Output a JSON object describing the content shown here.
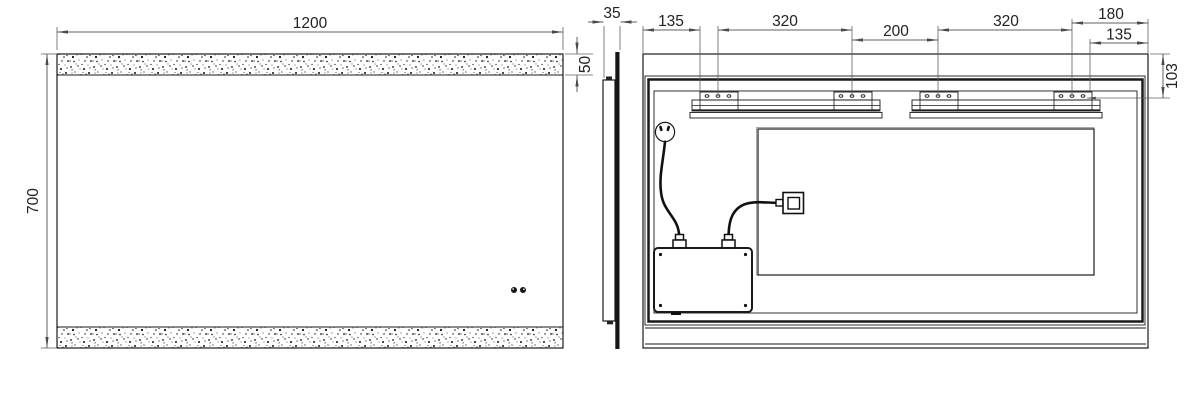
{
  "drawing": {
    "title": "LED mirror installation drawing",
    "front_view": {
      "width_label": "1200",
      "height_label": "700",
      "strip_height_label": "50"
    },
    "side_view": {
      "depth_label": "35"
    },
    "back_view": {
      "left_margin_label": "135",
      "rail1_span_label": "320",
      "center_gap_label": "200",
      "rail2_span_label": "320",
      "right_top_label": "180",
      "right_margin_label": "135",
      "bracket_drop_label": "103"
    }
  },
  "colors": {
    "line_color": "#1a1a1a",
    "dim_color": "#606060",
    "text_color": "#222222",
    "background": "#ffffff"
  }
}
